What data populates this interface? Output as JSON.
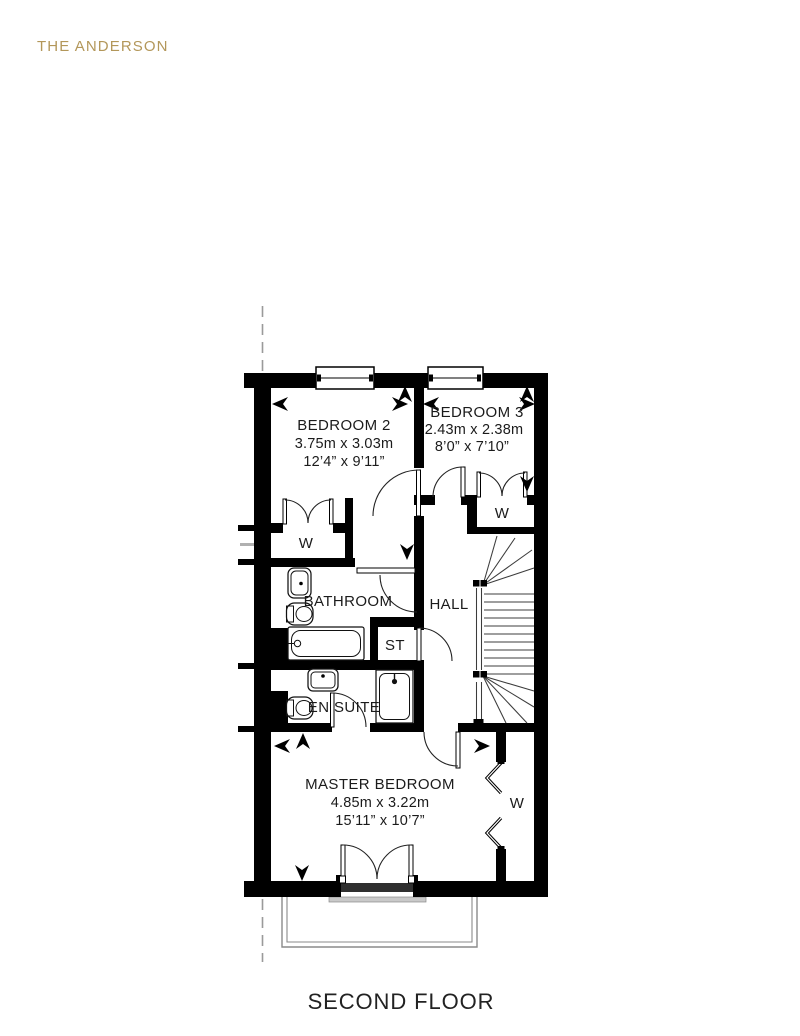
{
  "title": "THE ANDERSON",
  "floor_label": "SECOND FLOOR",
  "wardrobe_label": "W",
  "rooms": {
    "bedroom2": {
      "name": "BEDROOM 2",
      "metric": "3.75m x 3.03m",
      "imperial": "12’4” x 9’11”"
    },
    "bedroom3": {
      "name": "BEDROOM 3",
      "metric": "2.43m x 2.38m",
      "imperial": "8’0” x 7’10”"
    },
    "master_bedroom": {
      "name": "MASTER BEDROOM",
      "metric": "4.85m x 3.22m",
      "imperial": "15’11” x 10’7”"
    },
    "bathroom": {
      "name": "BATHROOM"
    },
    "en_suite": {
      "name": "EN SUITE"
    },
    "hall": {
      "name": "HALL"
    },
    "store": {
      "name": "ST"
    }
  },
  "colors": {
    "accent": "#b3975a",
    "walls": "#000000",
    "text": "#1b1b1b",
    "muted": "#999999"
  }
}
